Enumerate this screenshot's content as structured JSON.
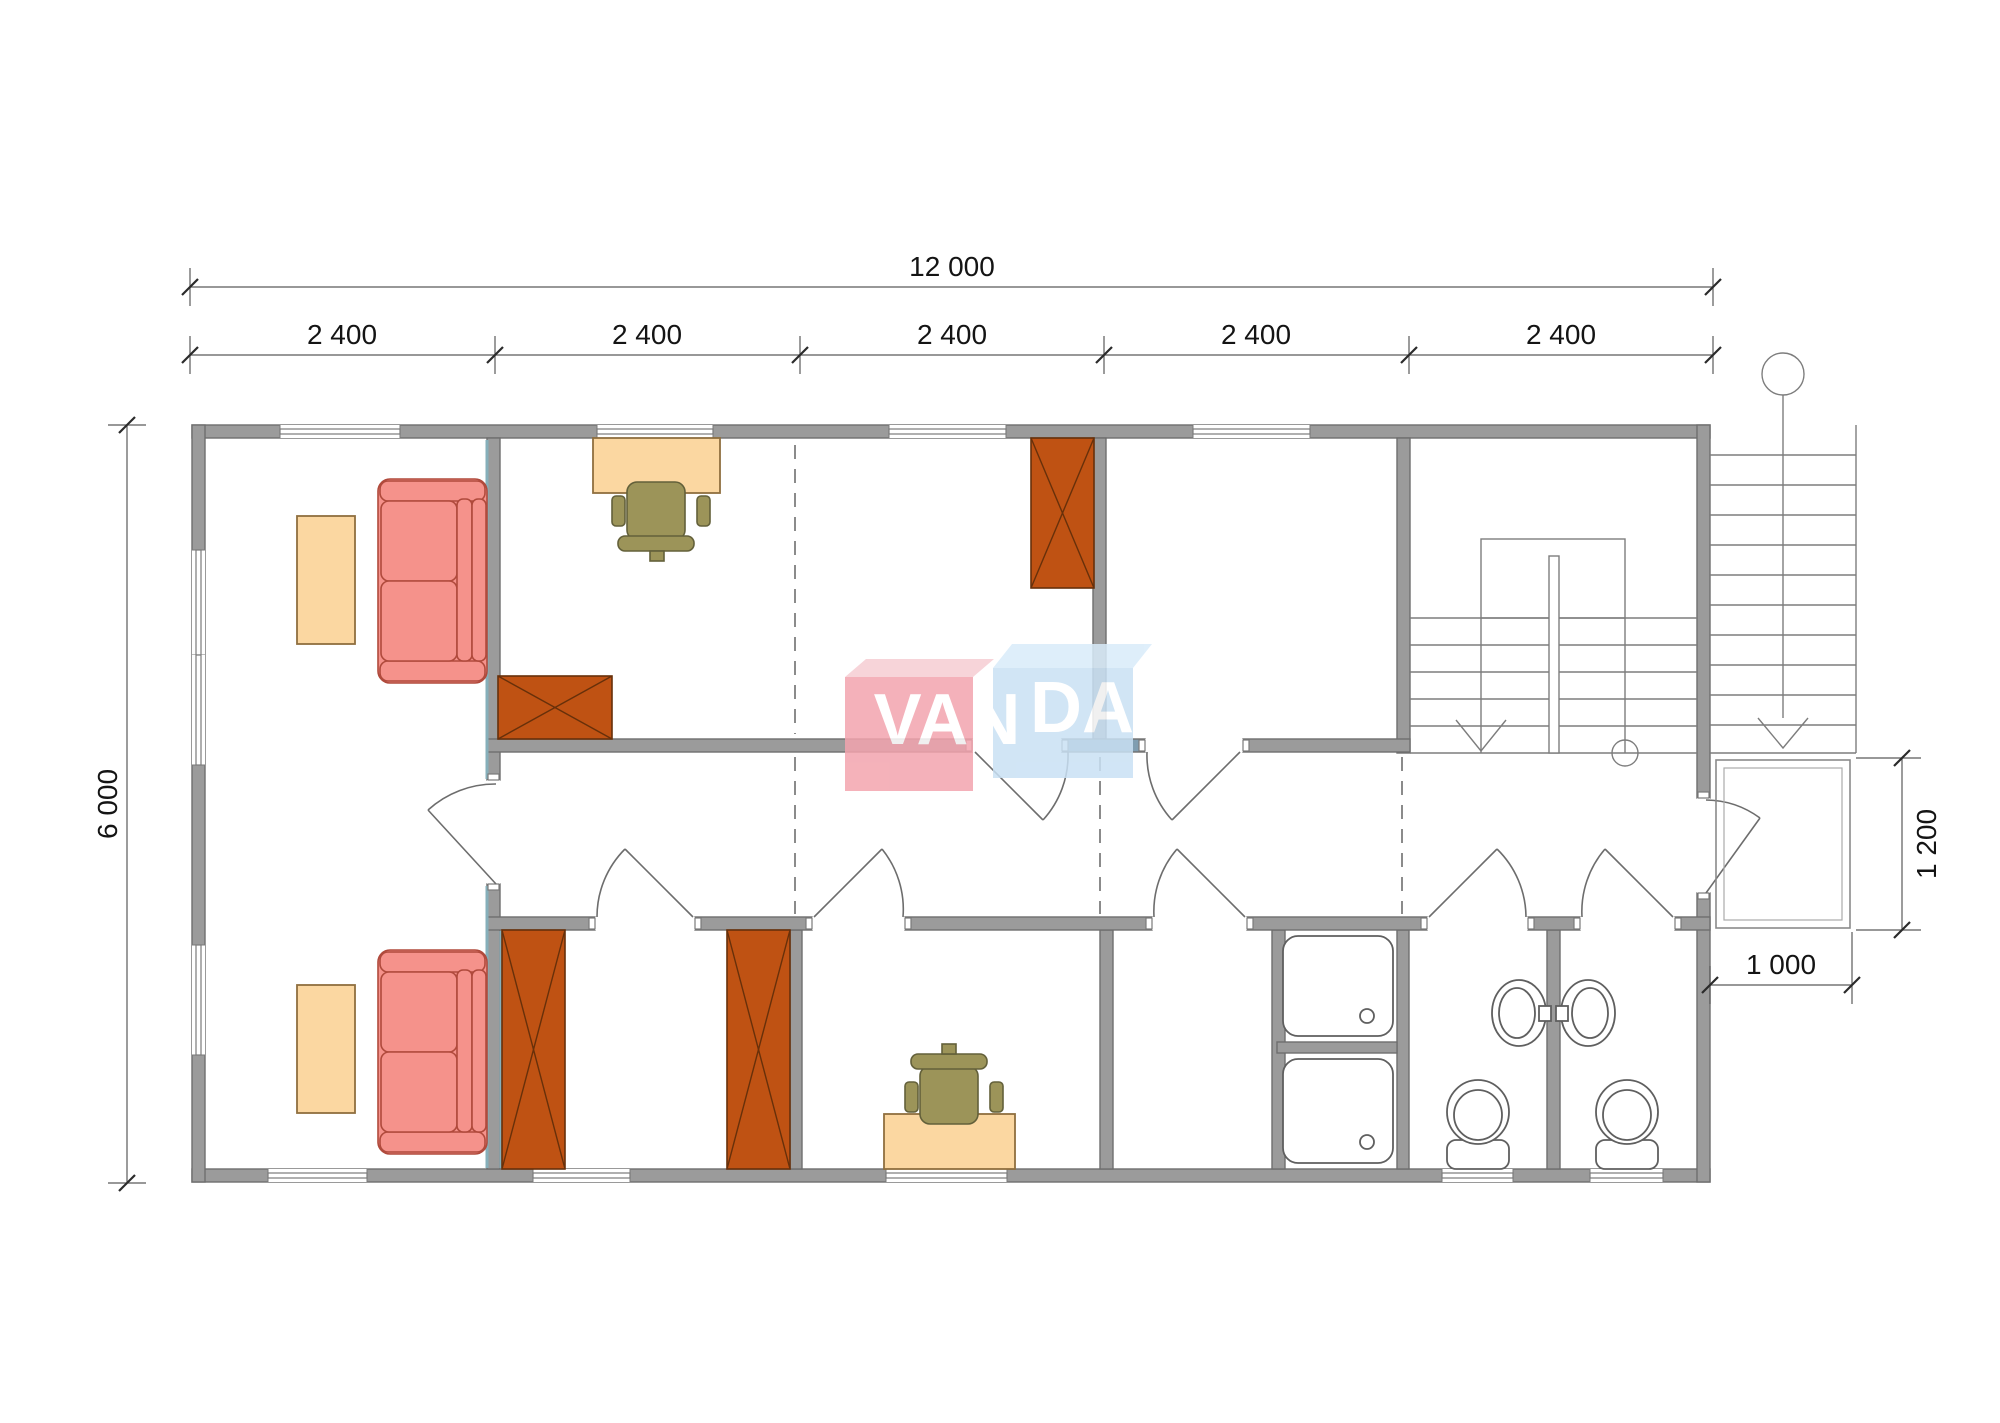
{
  "title": "floor-plan",
  "watermark": {
    "brand_left": "VAN",
    "brand_right": "DA"
  },
  "dimensions": {
    "top_total": "12 000",
    "top_segments": [
      "2 400",
      "2 400",
      "2 400",
      "2 400",
      "2 400"
    ],
    "left_height": "6 000",
    "entry_depth": "1 200",
    "entry_width": "1 000"
  },
  "colors": {
    "wall": "#9b9b9b",
    "wall-stroke": "#6e6e6e",
    "wall-accent": "#7f9db0",
    "teal": "#86afba",
    "sofa": "#f5928b",
    "sofa-stroke": "#b04a3c",
    "table": "#fbd7a1",
    "table-stroke": "#8f6f3f",
    "wardrobe": "#bf5213",
    "wardrobe-stroke": "#67300a",
    "chair": "#9c9459",
    "chair-stroke": "#63603a",
    "watermark-red": "#f3a4ae",
    "watermark-red-top": "#f6cdd3",
    "watermark-blue": "#c9e1f4",
    "watermark-blue-top": "#d9ecfa"
  },
  "objects": {
    "rooms": [
      "living-room",
      "office-room",
      "top-room",
      "stair-hall",
      "hallway",
      "bedroom-1",
      "bedroom-2",
      "small-room",
      "shower-room",
      "wc-1",
      "wc-2",
      "entry-porch"
    ],
    "furniture": [
      "sofa",
      "coffee-table",
      "wardrobe",
      "desk",
      "office-chair",
      "shower-tray",
      "wash-basin",
      "toilet",
      "staircase"
    ]
  }
}
